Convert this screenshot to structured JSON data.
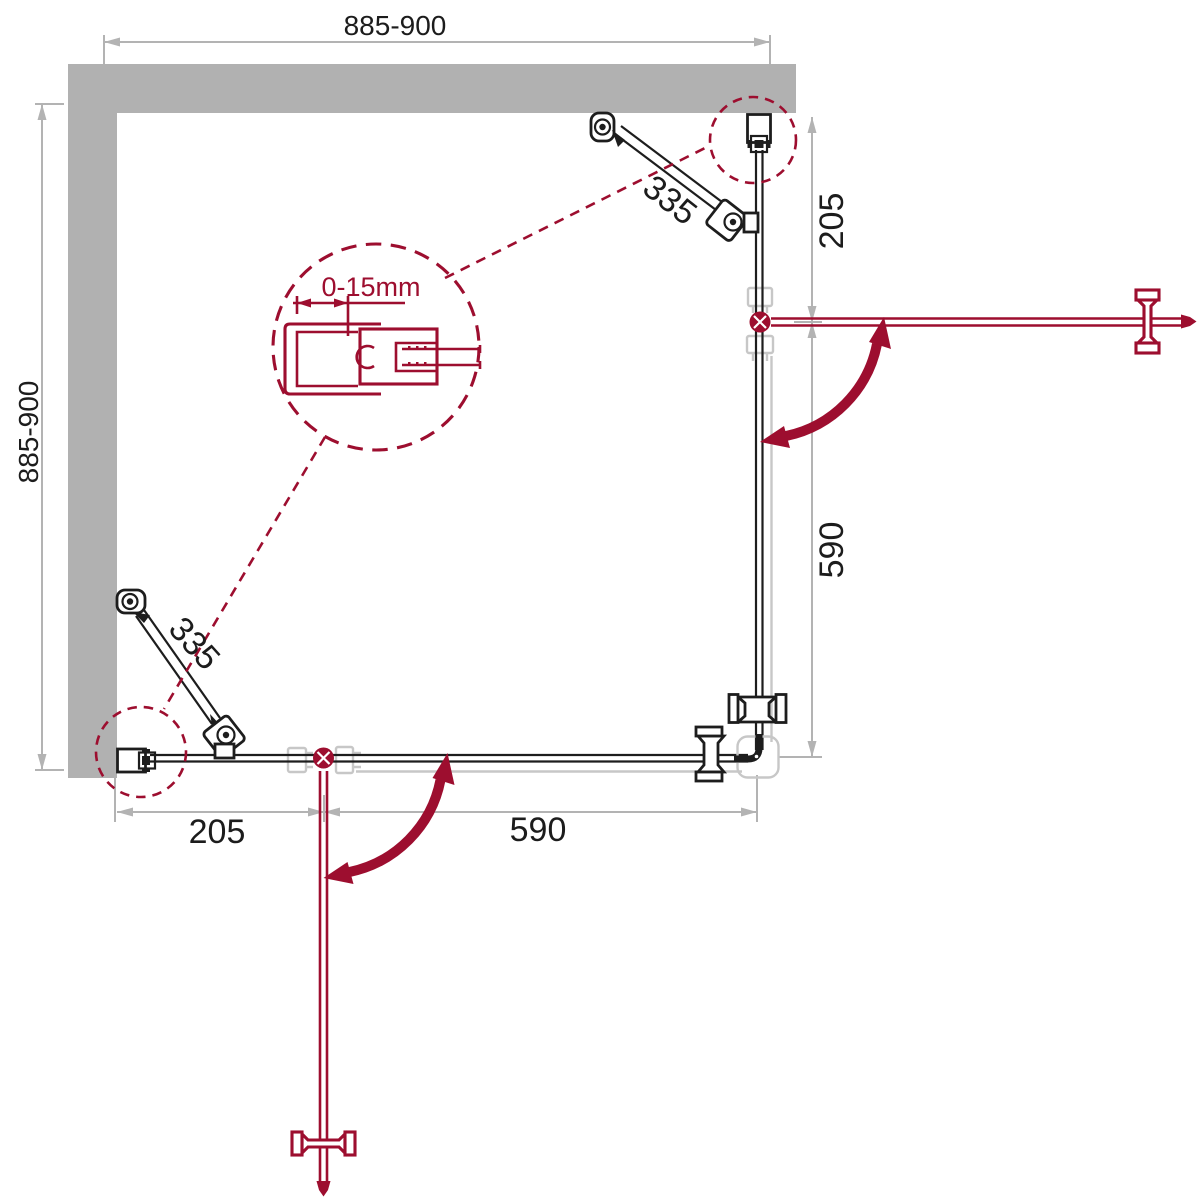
{
  "diagram": {
    "title": "shower-enclosure-installation-plan",
    "labels": {
      "width_top": "885-900",
      "height_left": "885-900",
      "right_fixed_segment": "205",
      "right_door_segment": "590",
      "bottom_fixed_segment": "205",
      "bottom_door_segment": "590",
      "support_bar_top": "335",
      "support_bar_bottom": "335",
      "detail_adjustment": "0-15mm"
    },
    "colors": {
      "accent": "#9d0e2f",
      "wall": "#b1b1b1",
      "line": "#1d1d1d",
      "dim": "#b3b3b3",
      "ghost": "#c7c7c7",
      "text": "#1c1c1c",
      "bg": "#ffffff"
    }
  }
}
